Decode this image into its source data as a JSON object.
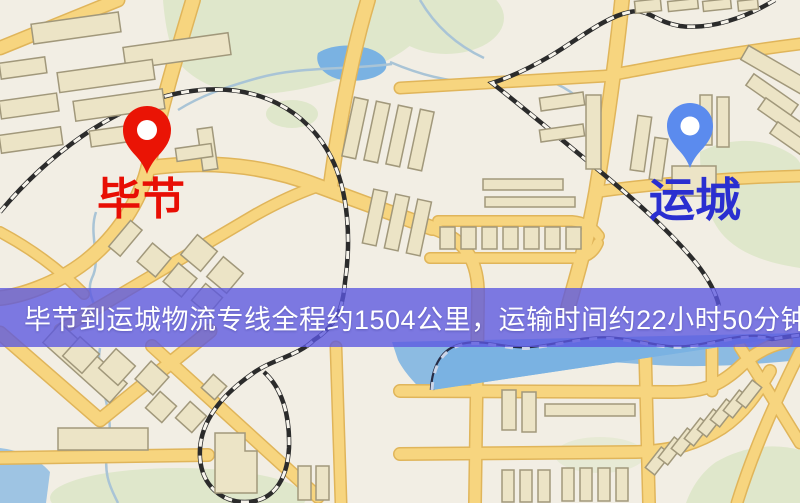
{
  "banner": {
    "text": "毕节到运城物流专线全程约1504公里，运输时间约22小时50分钟.",
    "background_color": "#5b57e0",
    "text_color": "#ffffff"
  },
  "origin": {
    "city": "毕节",
    "pin_color": "#ea1405",
    "label_color": "#e80e04"
  },
  "destination": {
    "city": "运城",
    "pin_color": "#5b8bee",
    "label_color": "#2a2fd0"
  },
  "route": {
    "distance_text": "约1504公里",
    "duration_text": "约22小时50分钟"
  },
  "map_palette": {
    "background": "#f2eee4",
    "road": "#f7d57f",
    "road_casing": "#e0b55a",
    "building": "#ece4c6",
    "building_stroke": "#a1987b",
    "park_green": "#dfe7cb",
    "water_blue": "#7ab2e2",
    "railway_dark": "#2b2b2b",
    "banner_overlay": "#5b57e0"
  }
}
